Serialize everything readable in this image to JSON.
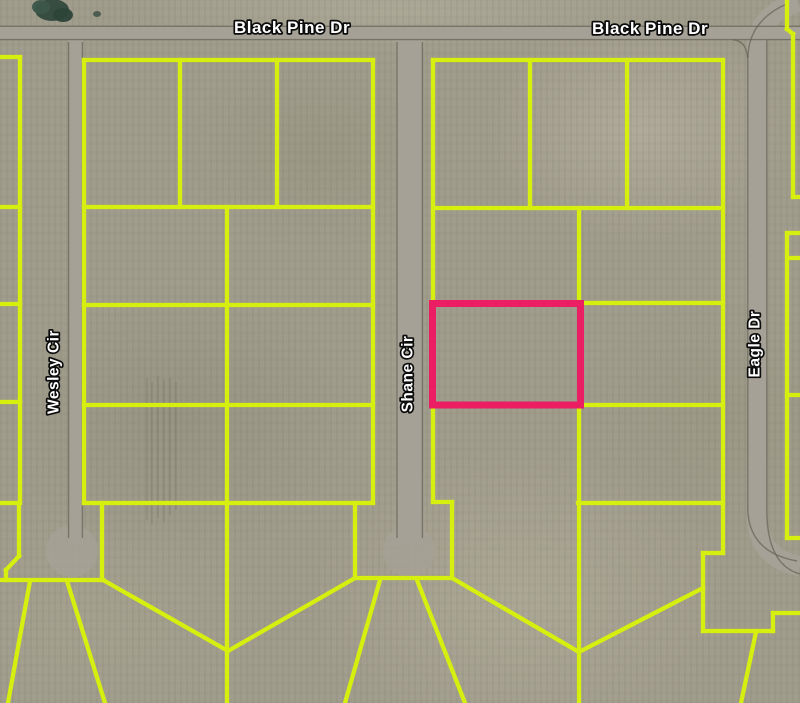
{
  "map": {
    "description": "Satellite parcel map with lot boundaries and a highlighted lot",
    "colors": {
      "field": "#a19d8d",
      "parcel_line": "#d6ef0e",
      "highlight": "#eb1d63",
      "road": "#a5a196",
      "road_edge": "#5f5d50",
      "label_fill": "#ffffff",
      "label_outline": "#0c0c0c",
      "tree": "#31493e"
    },
    "street_labels": [
      {
        "name": "black-pine-dr-label-west",
        "text": "Black Pine Dr",
        "x": 292,
        "y": 33,
        "rotate": 0,
        "size": 17
      },
      {
        "name": "black-pine-dr-label-east",
        "text": "Black Pine Dr",
        "x": 650,
        "y": 34,
        "rotate": 0,
        "size": 17
      },
      {
        "name": "wesley-cir-label",
        "text": "Wesley Cir",
        "x": 54,
        "y": 372,
        "rotate": -90,
        "size": 15.5
      },
      {
        "name": "shane-cir-label",
        "text": "Shane Cir",
        "x": 408,
        "y": 374,
        "rotate": -90,
        "size": 15.5
      },
      {
        "name": "eagle-dr-label",
        "text": "Eagle Dr",
        "x": 755,
        "y": 344,
        "rotate": -90,
        "size": 15.5
      }
    ],
    "highlight_parcel": {
      "x": 432.5,
      "y": 303.5,
      "w": 148,
      "h": 101.5
    },
    "parcel_segments": [
      [
        20,
        57,
        20,
        503
      ],
      [
        0,
        57,
        20,
        57
      ],
      [
        0,
        207,
        20,
        207
      ],
      [
        0,
        304,
        20,
        304
      ],
      [
        0,
        402,
        20,
        402
      ],
      [
        0,
        503,
        19,
        503
      ],
      [
        19,
        503,
        19,
        556
      ],
      [
        19,
        556,
        6,
        570
      ],
      [
        6,
        570,
        6,
        580
      ],
      [
        0,
        580,
        103,
        580
      ],
      [
        30,
        581,
        8,
        703
      ],
      [
        67,
        581,
        105,
        703
      ],
      [
        102,
        503,
        102,
        580
      ],
      [
        103,
        580,
        228,
        651
      ],
      [
        84,
        60,
        373,
        60
      ],
      [
        84,
        60,
        84,
        503
      ],
      [
        373,
        60,
        373,
        503
      ],
      [
        180,
        60,
        180,
        207
      ],
      [
        277,
        60,
        277,
        207
      ],
      [
        84,
        207,
        373,
        207
      ],
      [
        84,
        305,
        373,
        305
      ],
      [
        84,
        405,
        373,
        405
      ],
      [
        84,
        503,
        373,
        503
      ],
      [
        227,
        207,
        227,
        703
      ],
      [
        355,
        503,
        355,
        578
      ],
      [
        355,
        578,
        450,
        578
      ],
      [
        355,
        578,
        228,
        651
      ],
      [
        380,
        580,
        345,
        703
      ],
      [
        417,
        580,
        465,
        703
      ],
      [
        433,
        502,
        452,
        502
      ],
      [
        452,
        502,
        452,
        578
      ],
      [
        452,
        578,
        579,
        652
      ],
      [
        433,
        60,
        723,
        60
      ],
      [
        433,
        60,
        433,
        502
      ],
      [
        723,
        60,
        723,
        553
      ],
      [
        530,
        60,
        530,
        208
      ],
      [
        627,
        60,
        627,
        208
      ],
      [
        433,
        208,
        723,
        208
      ],
      [
        579,
        208,
        579,
        303
      ],
      [
        579,
        303,
        723,
        303
      ],
      [
        579,
        405,
        723,
        405
      ],
      [
        579,
        405,
        579,
        703
      ],
      [
        578,
        503,
        723,
        503
      ],
      [
        579,
        652,
        703,
        588
      ],
      [
        703,
        553,
        703,
        631
      ],
      [
        703,
        553,
        723,
        553
      ],
      [
        703,
        631,
        773,
        631
      ],
      [
        773,
        613,
        773,
        631
      ],
      [
        773,
        613,
        800,
        613
      ],
      [
        756,
        632,
        741,
        703
      ],
      [
        787,
        0,
        787,
        29
      ],
      [
        787,
        29,
        793,
        34
      ],
      [
        793,
        34,
        793,
        197
      ],
      [
        793,
        197,
        800,
        197
      ],
      [
        787,
        233,
        800,
        233
      ],
      [
        787,
        233,
        787,
        538
      ],
      [
        790,
        258,
        800,
        258
      ],
      [
        787,
        395,
        800,
        395
      ],
      [
        787,
        538,
        800,
        538
      ]
    ],
    "roads": {
      "rects": [
        [
          0,
          26,
          800,
          13.5
        ],
        [
          68,
          40,
          15,
          504
        ],
        [
          396,
          40,
          27,
          504
        ]
      ],
      "paths": [
        "M757,34 L757,515 Q757,558 800,566",
        "M757,46 Q759,14 798,2"
      ],
      "bulbs": [
        [
          72,
          551,
          26
        ],
        [
          409,
          551,
          26
        ]
      ],
      "edge_lines": [
        [
          0,
          26.3,
          800,
          26.3
        ],
        [
          0,
          39.6,
          800,
          39.6
        ],
        [
          68.6,
          42,
          68.6,
          538
        ],
        [
          82.4,
          42,
          82.4,
          538
        ],
        [
          397,
          42,
          397,
          538
        ],
        [
          422.4,
          42,
          422.4,
          538
        ]
      ],
      "edge_paths": [
        "M733,39.8 Q747.8,40.8 747.8,62 L747.8,508 Q748,552 797,561",
        "M766.8,40 L766.8,512 Q767.5,565 800,574",
        "M748,58 Q748,20 789,3"
      ]
    },
    "decor": {
      "trees": [
        [
          52,
          10,
          17,
          11,
          "#31493e"
        ],
        [
          41,
          7,
          9,
          7,
          "#3d564b"
        ],
        [
          63,
          15,
          10,
          7,
          "#2c4339"
        ],
        [
          97,
          14,
          4,
          3,
          "#49594d"
        ]
      ],
      "streaks": [
        [
          147,
          378,
          147,
          520
        ],
        [
          152,
          382,
          152,
          524
        ],
        [
          158,
          376,
          158,
          518
        ],
        [
          164,
          380,
          164,
          522
        ],
        [
          170,
          378,
          170,
          515
        ],
        [
          176,
          382,
          176,
          510
        ]
      ]
    }
  }
}
